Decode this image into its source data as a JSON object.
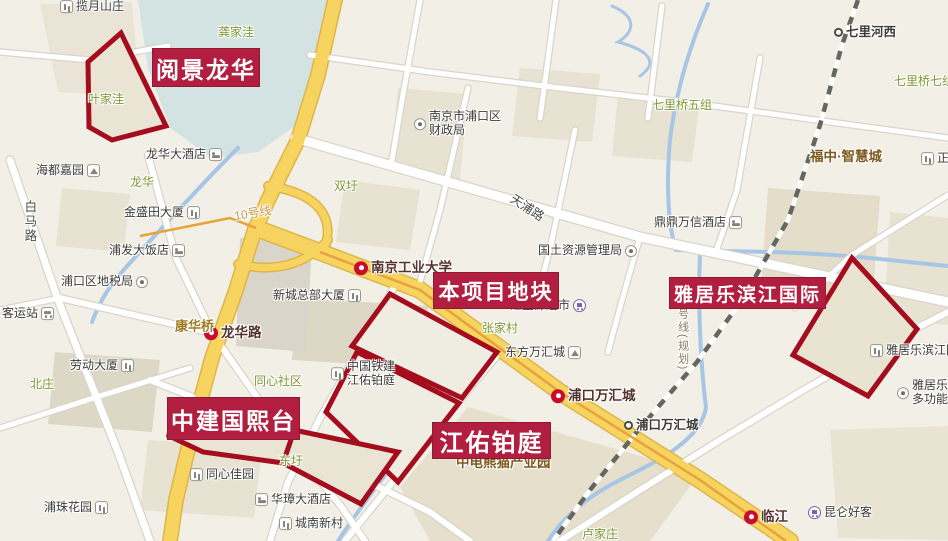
{
  "map_title": "南京浦口地块区位图",
  "colors": {
    "annotation_box": "#b11e3f",
    "annotation_outline": "#a30d1d",
    "water": "#a7c6e6",
    "pond": "#d2e3e2",
    "road_yellow": "#f6d45f",
    "road_yellow_casing": "#dfb54b",
    "road_white": "#ffffff",
    "road_casing": "#d8d5ca",
    "rail": "#666660",
    "metro_line": "#e9a23b",
    "village_text": "#7f9733",
    "poi_text": "#3b3b38",
    "station_text": "#53332c",
    "estate_text": "#7d5a1e"
  },
  "annotations": {
    "boxes": [
      {
        "label": "阅景龙华",
        "x": 152,
        "y": 48,
        "w": 106,
        "h": 37,
        "fs": 23
      },
      {
        "label": "本项目地块",
        "x": 433,
        "y": 272,
        "w": 124,
        "h": 35,
        "fs": 21
      },
      {
        "label": "雅居乐滨江国际",
        "x": 669,
        "y": 277,
        "w": 155,
        "h": 30,
        "fs": 19
      },
      {
        "label": "中建国熙台",
        "x": 167,
        "y": 397,
        "w": 131,
        "h": 41,
        "fs": 23
      },
      {
        "label": "江佑铂庭",
        "x": 432,
        "y": 422,
        "w": 117,
        "h": 35,
        "fs": 24
      }
    ],
    "outlined_plots": [
      {
        "name": "阅景龙华地块(叶家洼)",
        "points": "121,33 88,62 89,127 112,140 166,126"
      },
      {
        "name": "本项目地块(上)",
        "points": "390,294 497,352 462,398 352,346"
      },
      {
        "name": "江佑铂庭地块",
        "points": "357,352 459,403 398,482 326,412"
      },
      {
        "name": "中建国熙台地块(东圩)",
        "points": "294,430 398,452 361,504 283,463"
      },
      {
        "name": "中建国熙台地块(西)",
        "points": "167,435 294,431 283,463 203,452"
      },
      {
        "name": "雅居乐滨江国际地块",
        "points": "852,258 917,329 868,396 793,355"
      }
    ]
  },
  "pois": [
    {
      "text": "揽月山庄",
      "type": "dark",
      "icon": "bldg",
      "side": "l",
      "x": 60,
      "y": 7
    },
    {
      "text": "龚家洼",
      "type": "village",
      "icon": "none",
      "x": 218,
      "y": 33
    },
    {
      "text": "叶家洼",
      "type": "village",
      "icon": "none",
      "x": 88,
      "y": 100
    },
    {
      "text": "龙华",
      "type": "village",
      "icon": "none",
      "x": 130,
      "y": 183
    },
    {
      "text": "海都嘉园",
      "type": "dark",
      "icon": "mtn",
      "side": "r",
      "x": 36,
      "y": 171
    },
    {
      "text": "龙华大酒店",
      "type": "dark",
      "icon": "hotel",
      "side": "r",
      "x": 146,
      "y": 155
    },
    {
      "text": "金盛田大厦",
      "type": "dark",
      "icon": "bldg",
      "side": "r",
      "x": 124,
      "y": 213
    },
    {
      "text": "浦发大饭店",
      "type": "dark",
      "icon": "hotel",
      "side": "r",
      "x": 109,
      "y": 251
    },
    {
      "text": "浦口区地税局",
      "type": "dark",
      "icon": "gov",
      "side": "r",
      "x": 61,
      "y": 282
    },
    {
      "text": "客运站",
      "type": "dark",
      "icon": "bus",
      "side": "r",
      "x": 2,
      "y": 314
    },
    {
      "text": "龙华路",
      "type": "station",
      "icon": "metro",
      "side": "l",
      "x": 204,
      "y": 333
    },
    {
      "text": "北庄",
      "type": "village",
      "icon": "none",
      "x": 30,
      "y": 385
    },
    {
      "text": "劳动大厦",
      "type": "dark",
      "icon": "bldg",
      "side": "r",
      "x": 70,
      "y": 366
    },
    {
      "text": "浦珠花园",
      "type": "dark",
      "icon": "bldg",
      "side": "r",
      "x": 44,
      "y": 508
    },
    {
      "text": "同心社区",
      "type": "village",
      "icon": "none",
      "x": 254,
      "y": 382
    },
    {
      "text": "同心佳园",
      "type": "dark",
      "icon": "bldg",
      "side": "l",
      "x": 190,
      "y": 475
    },
    {
      "text": "华璋大酒店",
      "type": "dark",
      "icon": "hotel",
      "side": "l",
      "x": 255,
      "y": 500
    },
    {
      "text": "城南新村",
      "type": "dark",
      "icon": "bldg",
      "side": "l",
      "x": 279,
      "y": 524
    },
    {
      "text": "东圩",
      "type": "village",
      "icon": "none",
      "x": 279,
      "y": 462
    },
    {
      "text": "康华桥",
      "type": "bridge",
      "icon": "none",
      "x": 175,
      "y": 327
    },
    {
      "text": "新城总部大厦",
      "type": "dark",
      "icon": "bldg",
      "side": "r",
      "x": 273,
      "y": 296
    },
    {
      "text": "双圩",
      "type": "village",
      "icon": "none",
      "x": 334,
      "y": 187
    },
    {
      "lines": [
        "南京市浦口区",
        "财政局"
      ],
      "type": "dark",
      "icon": "gov",
      "side": "l",
      "x": 414,
      "y": 124
    },
    {
      "text": "天浦路",
      "type": "roadname",
      "icon": "none",
      "x": 527,
      "y": 208,
      "rot": 33
    },
    {
      "text": "南京工业大学",
      "type": "station",
      "icon": "metro",
      "side": "l",
      "x": 354,
      "y": 268
    },
    {
      "text": "张家村",
      "type": "village",
      "icon": "none",
      "x": 482,
      "y": 329
    },
    {
      "text": "国土资源管理局",
      "type": "dark",
      "icon": "gov",
      "side": "r",
      "x": 538,
      "y": 251
    },
    {
      "text": "汇盛源超市",
      "type": "dark",
      "icon": "cart",
      "side": "r",
      "x": 510,
      "y": 306
    },
    {
      "text": "东方万汇城",
      "type": "dark",
      "icon": "mtn",
      "side": "r",
      "x": 505,
      "y": 353
    },
    {
      "text": "浦口万汇城",
      "type": "station",
      "icon": "metro",
      "side": "l",
      "x": 551,
      "y": 396
    },
    {
      "text": "浦口万汇城",
      "type": "railname",
      "icon": "rail",
      "side": "l",
      "x": 624,
      "y": 425
    },
    {
      "text": "鼎鼎万信酒店",
      "type": "dark",
      "icon": "hotel",
      "side": "r",
      "x": 654,
      "y": 223
    },
    {
      "text": "七里桥五组",
      "type": "village",
      "icon": "none",
      "x": 652,
      "y": 106
    },
    {
      "text": "七里河西",
      "type": "railname",
      "icon": "rail",
      "side": "l",
      "x": 834,
      "y": 32
    },
    {
      "text": "七里桥七组",
      "type": "village",
      "icon": "none",
      "x": 894,
      "y": 82
    },
    {
      "text": "福中·智慧城",
      "type": "estate",
      "icon": "none",
      "x": 810,
      "y": 157
    },
    {
      "text": "正",
      "type": "dark",
      "icon": "bldg",
      "side": "l",
      "x": 921,
      "y": 159
    },
    {
      "text": "雅居乐滨江国",
      "type": "dark",
      "icon": "bldg",
      "side": "l",
      "x": 870,
      "y": 351
    },
    {
      "lines": [
        "雅居乐滨",
        "多功能酒"
      ],
      "type": "dark",
      "icon": "gov",
      "side": "l",
      "x": 897,
      "y": 393
    },
    {
      "text": "昆仑好客",
      "type": "dark",
      "icon": "cart",
      "side": "l",
      "x": 808,
      "y": 513
    },
    {
      "text": "临江",
      "type": "station",
      "icon": "metro",
      "side": "l",
      "x": 744,
      "y": 517
    },
    {
      "text": "卢家庄",
      "type": "village",
      "icon": "none",
      "x": 582,
      "y": 535
    },
    {
      "lines": [
        "中国铁建",
        "江佑铂庭"
      ],
      "type": "dark",
      "icon": "bldg",
      "side": "l",
      "x": 331,
      "y": 374
    },
    {
      "text": "中电熊猫产业园",
      "type": "estate",
      "icon": "none",
      "x": 456,
      "y": 463
    },
    {
      "text": "白马路",
      "type": "roadname",
      "icon": "none",
      "x": 22,
      "y": 200,
      "vertical": true
    },
    {
      "text": "10号线",
      "type": "metroline",
      "icon": "none",
      "x": 253,
      "y": 214,
      "rot": -9
    },
    {
      "text": "号线(规划)",
      "type": "planned",
      "icon": "none",
      "x": 676,
      "y": 308,
      "vertical": true
    }
  ]
}
